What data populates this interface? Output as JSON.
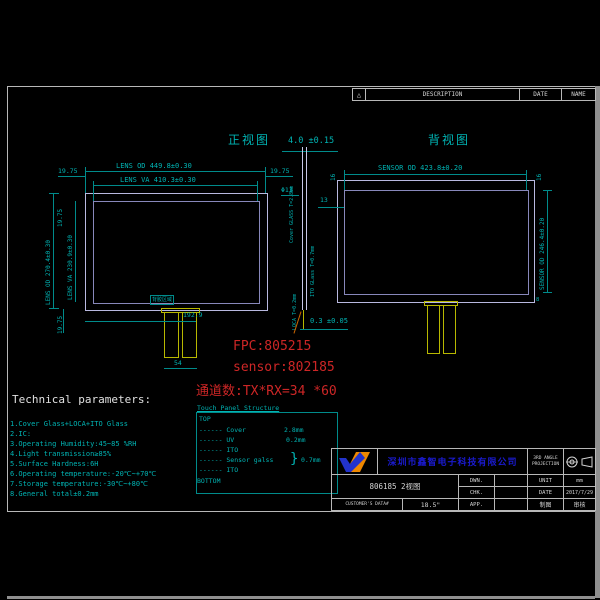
{
  "revision_header": {
    "marker": "△",
    "description": "DESCRIPTION",
    "date": "DATE",
    "name": "NAME"
  },
  "front_view": {
    "title": "正视图",
    "lens_od_w": "LENS OD 449.8±0.30",
    "lens_va_w": "LENS VA 410.3±0.30",
    "margin_top_left": "19.75",
    "margin_top_right": "19.75",
    "hole": "Φ13",
    "lens_od_h": "LENS OD 270.4±0.30",
    "lens_va_h": "LENS VA 230.9±0.30",
    "margin_top_v": "19.75",
    "margin_bottom_v": "19.75",
    "fpc_offset": "192.9",
    "fpc_width": "54",
    "adhesive_label": "背胶区域"
  },
  "side_view": {
    "thickness": "4.0 ±0.15",
    "cover_label": "Cover GLASS T=2.8mm",
    "ito_label": "ITO GLass T=0.7mm",
    "loca_label": "LOCA T=0.2mm",
    "bottom_gap": "0.3 ±0.05"
  },
  "rear_view": {
    "title": "背视图",
    "sensor_od_w": "SENSOR OD 423.8±0.20",
    "sensor_od_h": "SENSOR OD 246.4±0.20",
    "margin_left_16": "16",
    "margin_right_16": "16",
    "offset_13": "13",
    "offset_8": "8"
  },
  "annotations": {
    "fpc": "FPC:805215",
    "sensor": "sensor:802185",
    "channels": "通道数:TX*RX=34 *60"
  },
  "technical_parameters": {
    "title": "Technical parameters:",
    "items": [
      "1.Cover Glass+LOCA+ITO Glass",
      "2.IC:",
      "3.Operating Humidity:45~85 %RH",
      "4.Light transmission≥85%",
      "5.Surface Hardness:6H",
      "6.Operating temperature:-20℃~+70℃",
      "7.Storage temperature:-30℃~+80℃",
      "8.General total±0.2mm"
    ]
  },
  "structure_table": {
    "title": "Touch Panel Structure",
    "top": "TOP",
    "bottom": "BOTTOM",
    "brace": "}",
    "rows": [
      {
        "label": "------ Cover",
        "value": "2.8mm"
      },
      {
        "label": "------ UV",
        "value": "0.2mm"
      },
      {
        "label": "------ ITO",
        "value": ""
      },
      {
        "label": "------ Sensor galss",
        "value": "0.7mm"
      },
      {
        "label": "------ ITO",
        "value": ""
      }
    ]
  },
  "title_block": {
    "company": "深圳市鑫智电子科技有限公司",
    "projection_line1": "3RD ANGLE",
    "projection_line2": "PROJECTION",
    "drawing_title": "806185 2视图",
    "dwn_label": "DWN.",
    "chk_label": "CHK.",
    "app_label": "APP.",
    "unit_label": "UNIT",
    "unit_value": "mm",
    "date_label": "DATE",
    "date_value": "2017/7/29",
    "customer_label": "CUSTOMER'S DATA#",
    "size_value": "18.5\"",
    "cell_a": "制图",
    "cell_b": "审核"
  }
}
